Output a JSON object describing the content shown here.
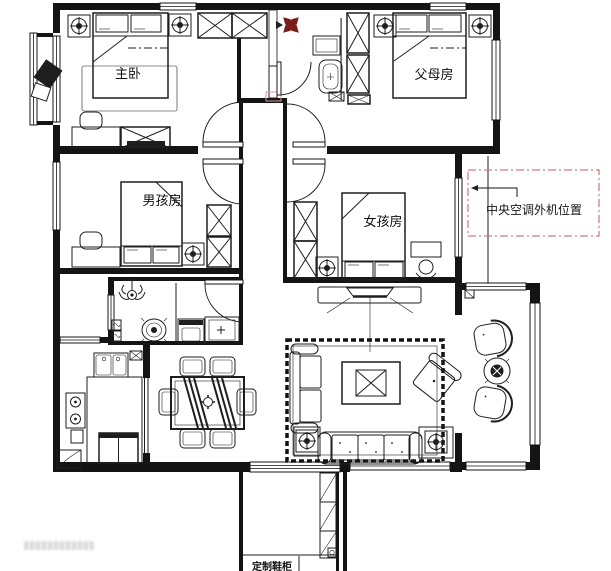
{
  "plan": {
    "rooms": {
      "master_bedroom": "主卧",
      "parents_room": "父母房",
      "boys_room": "男孩房",
      "girls_room": "女孩房"
    },
    "annotations": {
      "ac_outdoor_unit": "中央空调外机位置",
      "balcony_cabinet": "定制鞋柜"
    },
    "colors": {
      "wall": "#141414",
      "annotation_box": "#cf7e7e",
      "door_marker": "#dc9a9a",
      "compass": "#7a1c1c"
    }
  }
}
